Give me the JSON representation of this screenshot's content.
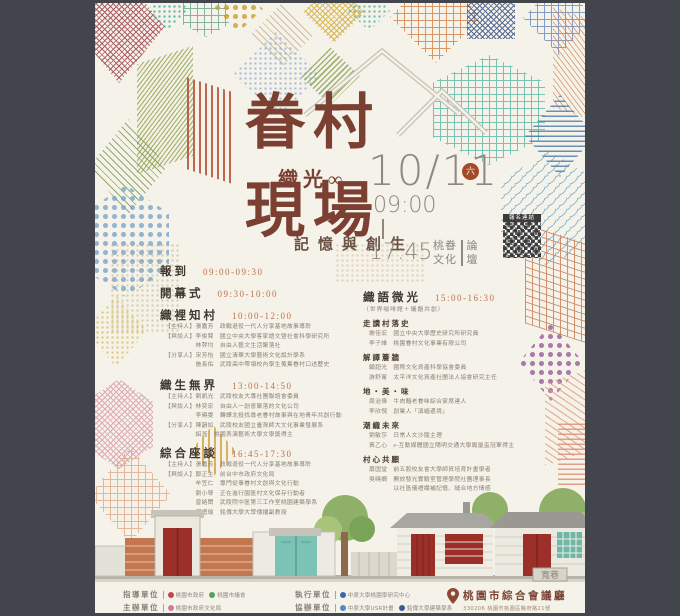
{
  "poster": {
    "title_top": "眷村",
    "title_mid": "織光∞",
    "title_bottom": "現場",
    "subtitle": "記憶與創生",
    "date": "10/11",
    "weekday": "六",
    "time_start": "09:00",
    "time_end": "17:45",
    "forum_col1": "桃眷",
    "forum_col2": "文化",
    "forum_col3": "論",
    "forum_col4": "壇",
    "qr_label": "報名連結"
  },
  "sessions": [
    {
      "name": "報到",
      "time": "09:00-09:30",
      "lines": []
    },
    {
      "name": "開幕式",
      "time": "09:30-10:00",
      "lines": []
    },
    {
      "name": "織裡知村",
      "time": "10:00-12:00",
      "lines": [
        "【主持人】張嘉芳　政戰退役一代人分享基地故事導聆",
        "【與談人】李俊賢　國立中央大學客家語文暨社會科學研究所",
        "　　　　　林羿均　自由人藝文生活聚落社",
        "【分享人】宋芳怡　國立清華大學藝術文化設計學系",
        "　　　　　施長佑　武陵高中帶領校內學生蒐集眷村口述歷史"
      ]
    },
    {
      "name": "織生無界",
      "time": "13:00-14:50",
      "lines": [
        "【主持人】劉凱光　武陵校友大專社團聯誼會委員",
        "【與談人】林奕宏　自由人一創意聚落的文化公司",
        "　　　　　李曉雯　轉譯北投找尋老眷村故事與在地青年共創行動",
        "【分享人】陳韻如　武陵校友國立臺灣師大文化事業發展系",
        "　　　　　絽湉　桃園表演藝術大學文學獎得主"
      ]
    },
    {
      "name": "綜合座談",
      "time": "16:45-17:30",
      "lines": [
        "【主持人】張嘉芳　政戰退役一代人分享基地故事導聆",
        "【與談人】鄭正生　前台中市政府文化局",
        "　　　　　牟笠仁　專門從事眷村文創與文化行動",
        "　　　　　劉小琴　正在進行園區村文化保存行動者",
        "　　　　　曾絡閎　武陵院中區第三工作室桃園建築學系",
        "　　　　　鄧迺瑜　銘傳大學大眾傳播副教授"
      ]
    }
  ],
  "workshop": {
    "name": "織語微光",
    "time": "15:00-16:30",
    "note": "（世界咖啡館＋議題共創）",
    "topics": [
      {
        "name": "走讀村落史",
        "lines": [
          "謝佳宏　國立中央大學歷史研究所研究員",
          "李子維　桃園眷村文化事業有限公司"
        ]
      },
      {
        "name": "解譯簷牆",
        "lines": [
          "顧超光　國際文化資產科學協會委員",
          "游舒甯　太平洋文化資產社團法人協會研究主任"
        ]
      },
      {
        "name": "地・美・味",
        "lines": [
          "周治偉　牛肉麵老眷味綜合宴席達人",
          "李欣俔　創業人「滇緬邊境」"
        ]
      },
      {
        "name": "潮織未來",
        "lines": [
          "劉敏莎　日常人文沙龍主理",
          "黃乙心　e-互動媒體國立陽明交通大學鳳凰盃冠軍得主"
        ]
      },
      {
        "name": "村心共願",
        "lines": [
          "蕭国堂　前五股校友會大學師資培育計畫學者",
          "吳曉姍　開放發光實驗室管理學院社團理事長",
          "　　　　以社區儀禮織補記憶、縫合地方情感"
        ]
      }
    ]
  },
  "illustration": {
    "sign": "寬巷"
  },
  "footer": {
    "credits": [
      {
        "label": "指導單位",
        "logos": [
          "桃園市政府",
          "桃園市議會"
        ]
      },
      {
        "label": "主辦單位",
        "logos": [
          "桃園市政府文化局"
        ]
      },
      {
        "label": "執行單位",
        "logos": [
          "中原大學桃園學研究中心"
        ]
      },
      {
        "label": "協辦單位",
        "logos": [
          "中原大學USR計畫",
          "銘傳大學建築學系"
        ]
      }
    ],
    "venue": {
      "name": "桃園市綜合會議廳",
      "address": "330206 桃園市桃園區縣府路21號"
    }
  }
}
